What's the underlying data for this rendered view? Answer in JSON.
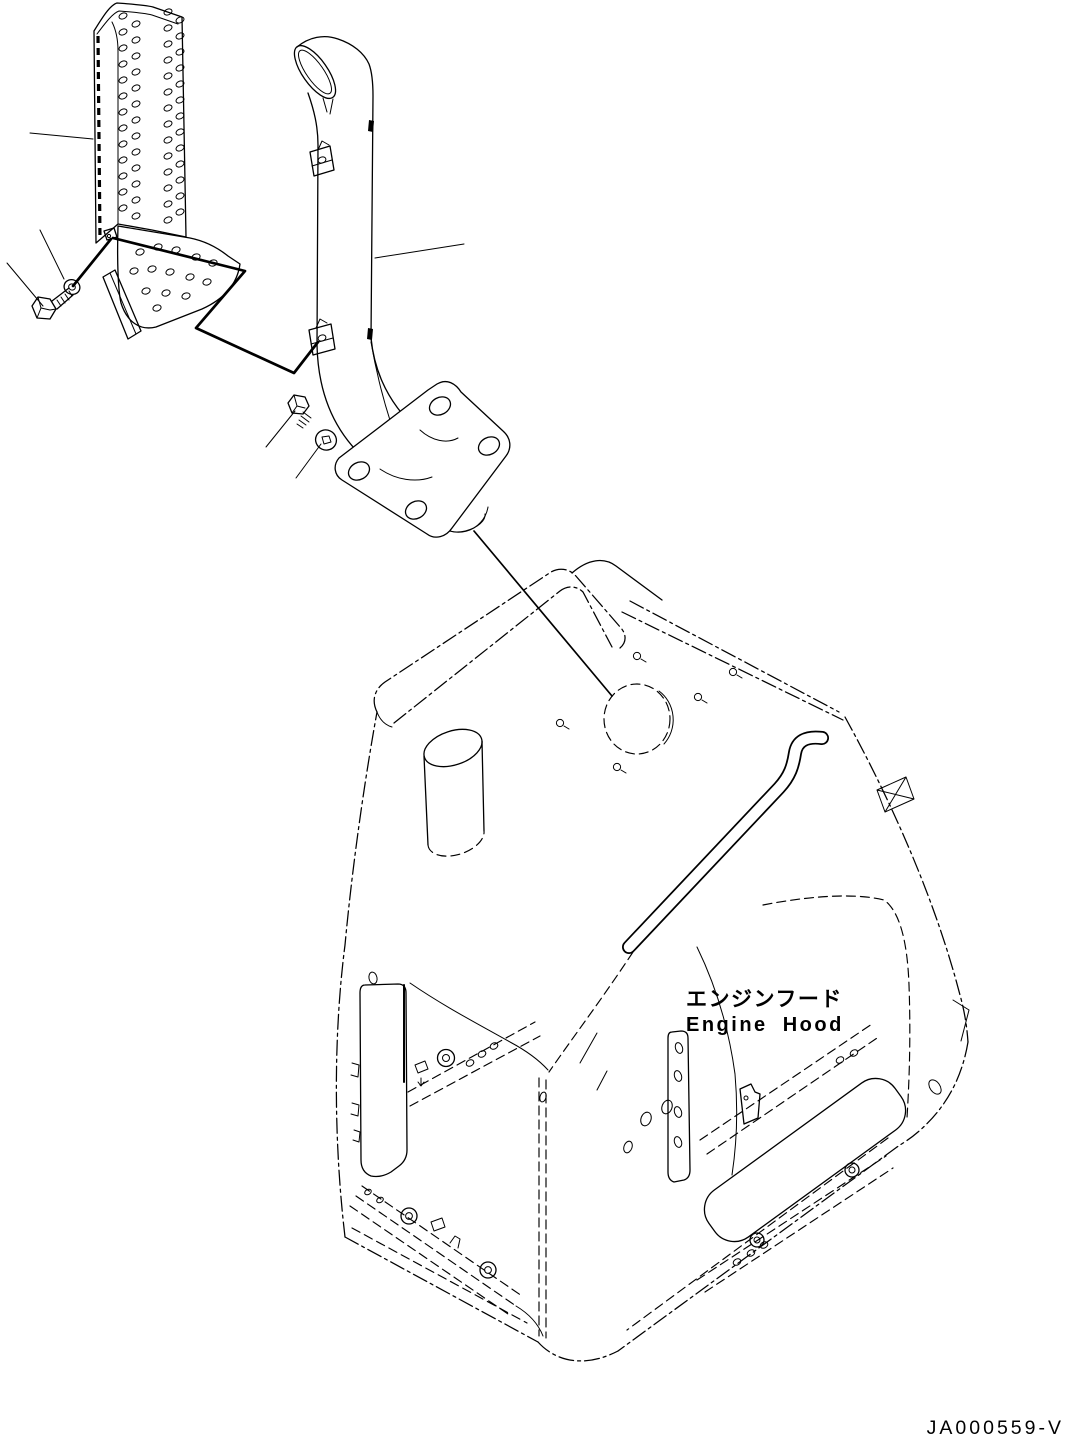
{
  "diagram": {
    "callout_ja": "エンジンフード",
    "callout_en": "Engine Hood",
    "drawing_code": "JA000559-V"
  },
  "colors": {
    "ink": "#000000",
    "paper": "#ffffff"
  }
}
